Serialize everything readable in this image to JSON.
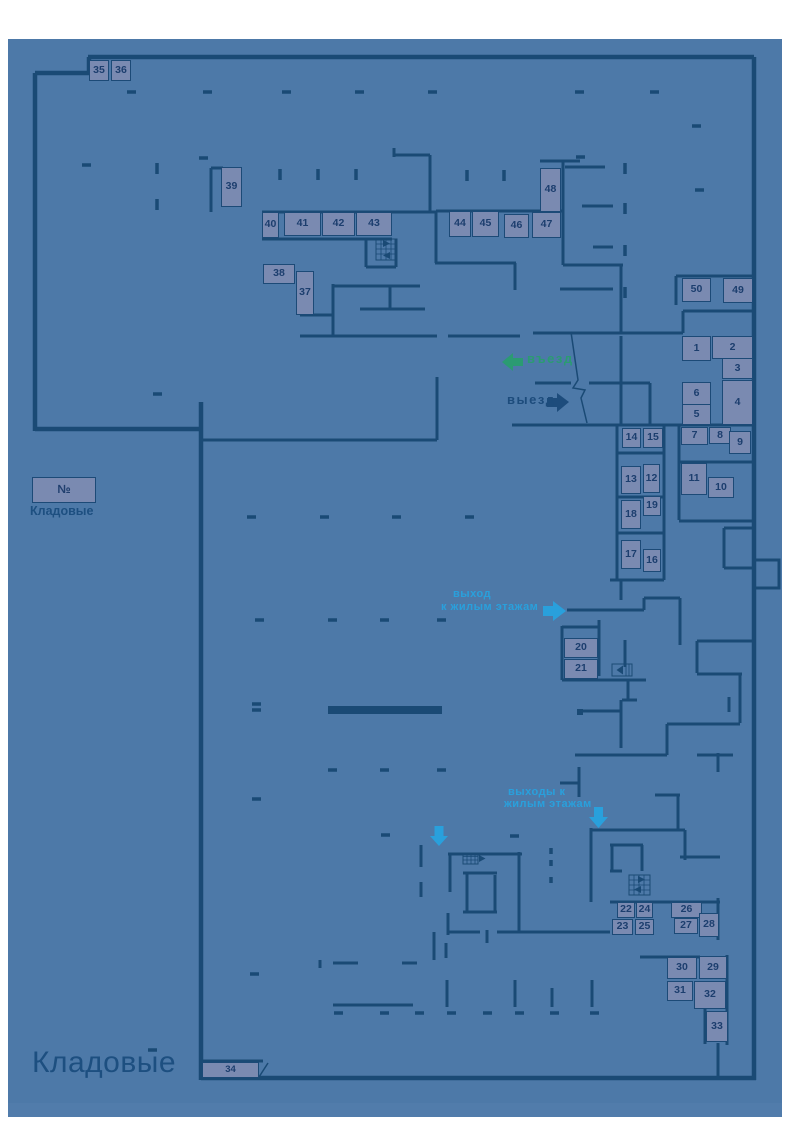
{
  "page": {
    "title": "Кладовые"
  },
  "legend": {
    "number_symbol": "№",
    "caption": "Кладовые"
  },
  "labels": {
    "entrance": "въезд",
    "exit": "выезд",
    "exit_residential_line1": "выход",
    "exit_residential_line2": "к жилым этажам",
    "exits_residential_line1": "выходы к",
    "exits_residential_line2": "жилым этажам"
  },
  "icons": {
    "entrance_arrow": "arrow-left",
    "exit_arrow": "arrow-right",
    "exit_residential_arrow": "arrow-right",
    "exits_residential_arrows": "arrow-down",
    "stairs": "stairs-hatch",
    "elevator": "elevator-box"
  },
  "colors": {
    "canvas": "#4d79a8",
    "wall": "#1a4a75",
    "unit_fill": "#7a8ab1",
    "unit_border": "#1c4a77",
    "number_text": "#1c3e6e",
    "entrance_green": "#2b9b72",
    "exit_navy": "#1d4c7c",
    "residential_cyan": "#29a0dc",
    "title_text": "#1d4f80"
  },
  "units": [
    {
      "n": "35",
      "x": 89,
      "y": 60,
      "w": 20,
      "h": 21
    },
    {
      "n": "36",
      "x": 111,
      "y": 60,
      "w": 20,
      "h": 21
    },
    {
      "n": "39",
      "x": 221,
      "y": 167,
      "w": 21,
      "h": 40
    },
    {
      "n": "40",
      "x": 262,
      "y": 212,
      "w": 17,
      "h": 26
    },
    {
      "n": "41",
      "x": 284,
      "y": 212,
      "w": 37,
      "h": 24
    },
    {
      "n": "42",
      "x": 322,
      "y": 212,
      "w": 33,
      "h": 24
    },
    {
      "n": "43",
      "x": 356,
      "y": 212,
      "w": 36,
      "h": 24
    },
    {
      "n": "44",
      "x": 449,
      "y": 211,
      "w": 22,
      "h": 26
    },
    {
      "n": "45",
      "x": 472,
      "y": 211,
      "w": 27,
      "h": 26
    },
    {
      "n": "46",
      "x": 504,
      "y": 214,
      "w": 25,
      "h": 24
    },
    {
      "n": "47",
      "x": 532,
      "y": 212,
      "w": 29,
      "h": 26
    },
    {
      "n": "48",
      "x": 540,
      "y": 168,
      "w": 21,
      "h": 44
    },
    {
      "n": "38",
      "x": 263,
      "y": 264,
      "w": 32,
      "h": 20
    },
    {
      "n": "37",
      "x": 296,
      "y": 271,
      "w": 18,
      "h": 44
    },
    {
      "n": "50",
      "x": 682,
      "y": 278,
      "w": 29,
      "h": 24
    },
    {
      "n": "49",
      "x": 723,
      "y": 278,
      "w": 30,
      "h": 25
    },
    {
      "n": "1",
      "x": 682,
      "y": 336,
      "w": 29,
      "h": 25
    },
    {
      "n": "2",
      "x": 712,
      "y": 336,
      "w": 41,
      "h": 23
    },
    {
      "n": "3",
      "x": 722,
      "y": 358,
      "w": 31,
      "h": 21
    },
    {
      "n": "6",
      "x": 682,
      "y": 382,
      "w": 29,
      "h": 23
    },
    {
      "n": "5",
      "x": 682,
      "y": 404,
      "w": 29,
      "h": 21
    },
    {
      "n": "4",
      "x": 722,
      "y": 380,
      "w": 31,
      "h": 45
    },
    {
      "n": "7",
      "x": 681,
      "y": 427,
      "w": 27,
      "h": 18
    },
    {
      "n": "8",
      "x": 709,
      "y": 427,
      "w": 22,
      "h": 17
    },
    {
      "n": "9",
      "x": 729,
      "y": 431,
      "w": 22,
      "h": 23
    },
    {
      "n": "14",
      "x": 622,
      "y": 428,
      "w": 19,
      "h": 20
    },
    {
      "n": "15",
      "x": 643,
      "y": 428,
      "w": 20,
      "h": 20
    },
    {
      "n": "13",
      "x": 621,
      "y": 466,
      "w": 20,
      "h": 28
    },
    {
      "n": "12",
      "x": 643,
      "y": 464,
      "w": 17,
      "h": 29
    },
    {
      "n": "11",
      "x": 681,
      "y": 463,
      "w": 26,
      "h": 32
    },
    {
      "n": "10",
      "x": 708,
      "y": 477,
      "w": 26,
      "h": 21
    },
    {
      "n": "18",
      "x": 621,
      "y": 500,
      "w": 20,
      "h": 29
    },
    {
      "n": "19",
      "x": 643,
      "y": 496,
      "w": 18,
      "h": 20
    },
    {
      "n": "17",
      "x": 621,
      "y": 540,
      "w": 20,
      "h": 29
    },
    {
      "n": "16",
      "x": 643,
      "y": 549,
      "w": 18,
      "h": 23
    },
    {
      "n": "20",
      "x": 564,
      "y": 638,
      "w": 34,
      "h": 20
    },
    {
      "n": "21",
      "x": 564,
      "y": 659,
      "w": 34,
      "h": 20
    },
    {
      "n": "22",
      "x": 617,
      "y": 902,
      "w": 18,
      "h": 16
    },
    {
      "n": "24",
      "x": 636,
      "y": 902,
      "w": 17,
      "h": 16
    },
    {
      "n": "23",
      "x": 612,
      "y": 919,
      "w": 21,
      "h": 16
    },
    {
      "n": "25",
      "x": 635,
      "y": 919,
      "w": 19,
      "h": 16
    },
    {
      "n": "26",
      "x": 671,
      "y": 902,
      "w": 31,
      "h": 16
    },
    {
      "n": "27",
      "x": 674,
      "y": 918,
      "w": 24,
      "h": 16
    },
    {
      "n": "28",
      "x": 699,
      "y": 913,
      "w": 20,
      "h": 24
    },
    {
      "n": "30",
      "x": 667,
      "y": 957,
      "w": 30,
      "h": 22
    },
    {
      "n": "29",
      "x": 699,
      "y": 956,
      "w": 28,
      "h": 23
    },
    {
      "n": "31",
      "x": 667,
      "y": 981,
      "w": 26,
      "h": 20
    },
    {
      "n": "32",
      "x": 694,
      "y": 981,
      "w": 32,
      "h": 28
    },
    {
      "n": "33",
      "x": 706,
      "y": 1011,
      "w": 22,
      "h": 31
    },
    {
      "n": "34",
      "x": 202,
      "y": 1062,
      "w": 57,
      "h": 16
    }
  ]
}
